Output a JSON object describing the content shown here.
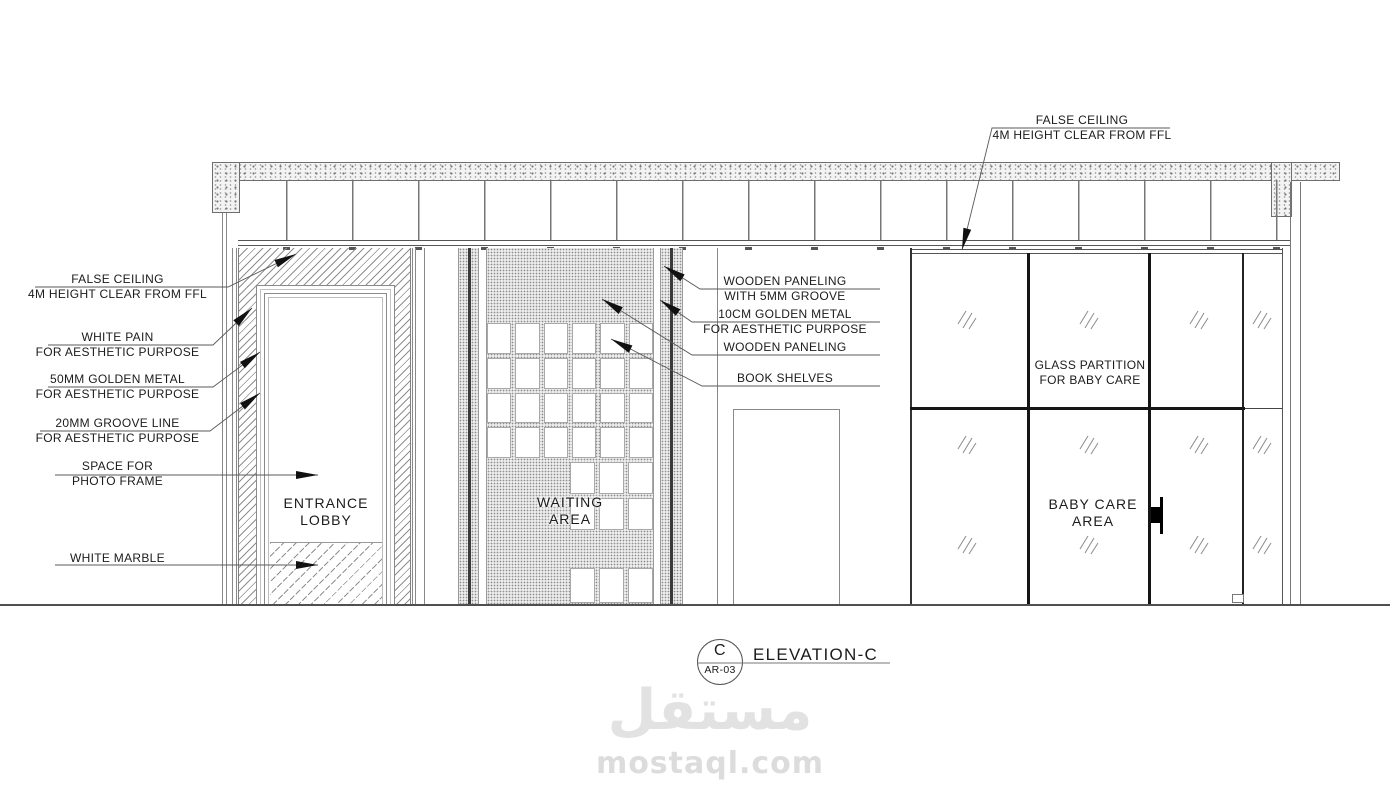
{
  "drawing": {
    "title": "ELEVATION-C",
    "bubble": {
      "letter": "C",
      "sheet": "AR-03"
    }
  },
  "watermark": {
    "logo_text": "مستقل",
    "site_text": "mostaql.com"
  },
  "labels": {
    "top_right": {
      "line1": "FALSE CEILING",
      "line2": "4M HEIGHT CLEAR FROM FFL"
    },
    "left": [
      {
        "line1": "FALSE CEILING",
        "line2": "4M HEIGHT CLEAR FROM FFL"
      },
      {
        "line1": "WHITE PAIN",
        "line2": "FOR AESTHETIC PURPOSE"
      },
      {
        "line1": "50MM GOLDEN METAL",
        "line2": "FOR AESTHETIC PURPOSE"
      },
      {
        "line1": "20MM GROOVE LINE",
        "line2": "FOR AESTHETIC PURPOSE"
      },
      {
        "line1": "SPACE FOR",
        "line2": "PHOTO FRAME"
      },
      {
        "line1": "WHITE MARBLE",
        "line2": ""
      }
    ],
    "middle": [
      {
        "line1": "WOODEN PANELING",
        "line2": "WITH 5MM GROOVE"
      },
      {
        "line1": "10CM GOLDEN METAL",
        "line2": "FOR AESTHETIC PURPOSE"
      },
      {
        "line1": "WOODEN PANELING",
        "line2": ""
      },
      {
        "line1": "BOOK SHELVES",
        "line2": ""
      }
    ],
    "areas": {
      "entrance_lobby": {
        "line1": "ENTRANCE",
        "line2": "LOBBY"
      },
      "waiting_area": {
        "line1": "WAITING",
        "line2": "AREA"
      },
      "glass_partition": {
        "line1": "GLASS PARTITION",
        "line2": "FOR BABY CARE"
      },
      "baby_care": {
        "line1": "BABY CARE",
        "line2": "AREA"
      }
    }
  },
  "shelves": {
    "main": {
      "cols": 6,
      "rows": 4
    },
    "right_block": {
      "cols": 3,
      "rows": 2
    },
    "bottom_row": {
      "cols": 3,
      "rows": 1
    }
  },
  "colors": {
    "line_dark": "#111111",
    "line_mid": "#555555",
    "watermark": "#e2e2e2"
  }
}
